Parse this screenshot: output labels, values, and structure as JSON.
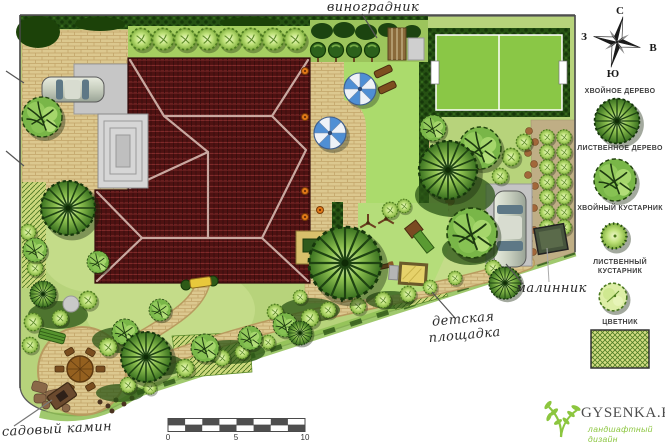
{
  "labels": {
    "vineyard": "виноградник",
    "raspberry_patch": "малинник",
    "playground_line1": "детская",
    "playground_line2": "площадка",
    "garden_fireplace": "садовый камин"
  },
  "compass": {
    "north": "С",
    "east": "В",
    "south": "Ю",
    "west": "З"
  },
  "legend": {
    "items": [
      {
        "label": "ХВОЙНОЕ ДЕРЕВО",
        "symbol": "conifer-tree"
      },
      {
        "label": "ЛИСТВЕННОЕ ДЕРЕВО",
        "symbol": "deciduous-tree"
      },
      {
        "label": "ХВОЙНЫЙ КУСТАРНИК",
        "symbol": "conifer-shrub"
      },
      {
        "label": "ЛИСТВЕННЫЙ КУСТАРНИК",
        "symbol": "deciduous-shrub"
      },
      {
        "label": "ЦВЕТНИК",
        "symbol": "flowerbed-swatch"
      }
    ]
  },
  "scale_bar": {
    "start": "0",
    "middle": "5",
    "end": "10"
  },
  "logo": {
    "site": "GYSENKA.RU",
    "tagline": "ландшафтный дизайн"
  },
  "colors": {
    "roof": "#521313",
    "lawn": "#b7d37b",
    "field": "#8ac746",
    "paving": "#dcc88f",
    "hedge": "#265113",
    "accent_green": "#8cc63f",
    "umbrella_blue": "#4f8fd4"
  }
}
